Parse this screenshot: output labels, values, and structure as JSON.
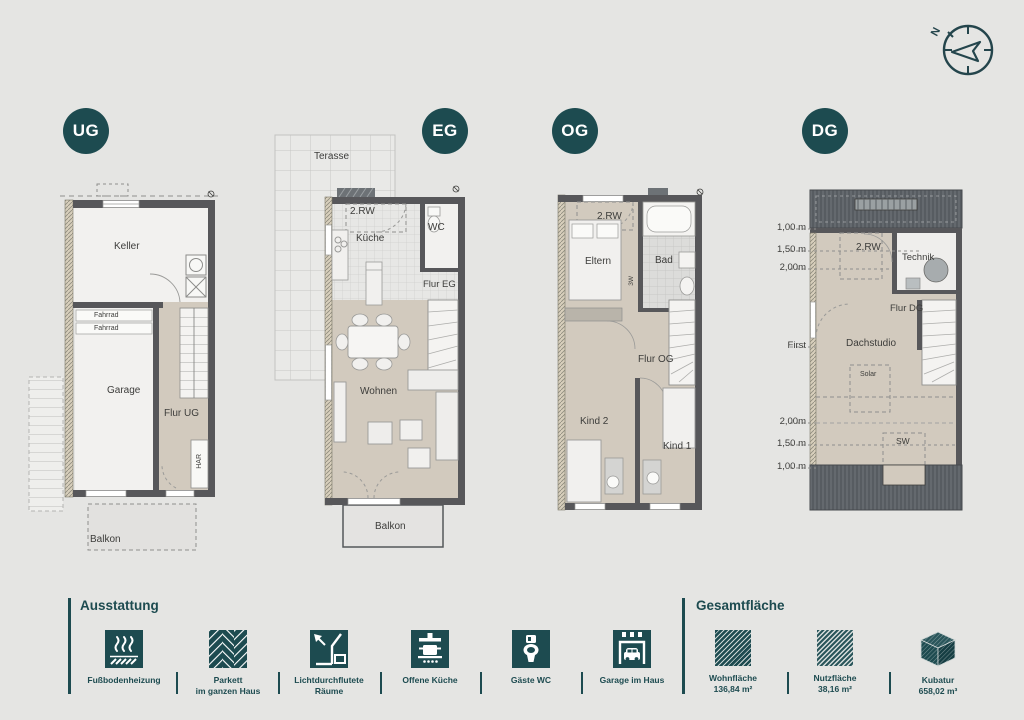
{
  "sheet": {
    "bg": "#e5e5e3",
    "accent": "#1d4b50"
  },
  "compass": {
    "north": "N"
  },
  "floors": {
    "ug": {
      "badge": "UG",
      "rooms": {
        "keller": "Keller",
        "fahrrad": "Fahrrad",
        "garage": "Garage",
        "flur": "Flur UG",
        "har": "HAR",
        "balkon": "Balkon"
      }
    },
    "eg": {
      "badge": "EG",
      "rooms": {
        "terasse": "Terasse",
        "rw": "2.RW",
        "kueche": "Küche",
        "wc": "WC",
        "flur": "Flur EG",
        "wohnen": "Wohnen",
        "balkon": "Balkon"
      }
    },
    "og": {
      "badge": "OG",
      "rooms": {
        "rw": "2.RW",
        "eltern": "Eltern",
        "bad": "Bad",
        "w3": "3W",
        "flur": "Flur OG",
        "kind2": "Kind 2",
        "kind1": "Kind 1"
      }
    },
    "dg": {
      "badge": "DG",
      "rooms": {
        "rw": "2.RW",
        "technik": "Technik",
        "flur": "Flur DG",
        "dachstudio": "Dachstudio",
        "solar": "Solar",
        "sw": "SW"
      },
      "first_label": "First",
      "dims_top": [
        "1,00 m",
        "1,50 m",
        "2,00m"
      ],
      "dims_bottom": [
        "2,00m",
        "1,50 m",
        "1,00 m"
      ]
    }
  },
  "legend": {
    "ausstattung": {
      "title": "Ausstattung",
      "items": [
        {
          "icon": "floor-heating-icon",
          "line1": "Fußbodenheizung",
          "line2": ""
        },
        {
          "icon": "parquet-icon",
          "line1": "Parkett",
          "line2": "im ganzen Haus"
        },
        {
          "icon": "daylight-rooms-icon",
          "line1": "Lichtdurchflutete",
          "line2": "Räume"
        },
        {
          "icon": "open-kitchen-icon",
          "line1": "Offene Küche",
          "line2": ""
        },
        {
          "icon": "guest-wc-icon",
          "line1": "Gäste WC",
          "line2": ""
        },
        {
          "icon": "garage-icon",
          "line1": "Garage im Haus",
          "line2": ""
        }
      ]
    },
    "gesamtflaeche": {
      "title": "Gesamtfläche",
      "items": [
        {
          "icon": "living-area-swatch",
          "label": "Wohnfläche",
          "value": "136,84 m²"
        },
        {
          "icon": "usable-area-swatch",
          "label": "Nutzfläche",
          "value": "38,16 m²"
        },
        {
          "icon": "volume-cube-icon",
          "label": "Kubatur",
          "value": "658,02 m³"
        }
      ]
    }
  }
}
